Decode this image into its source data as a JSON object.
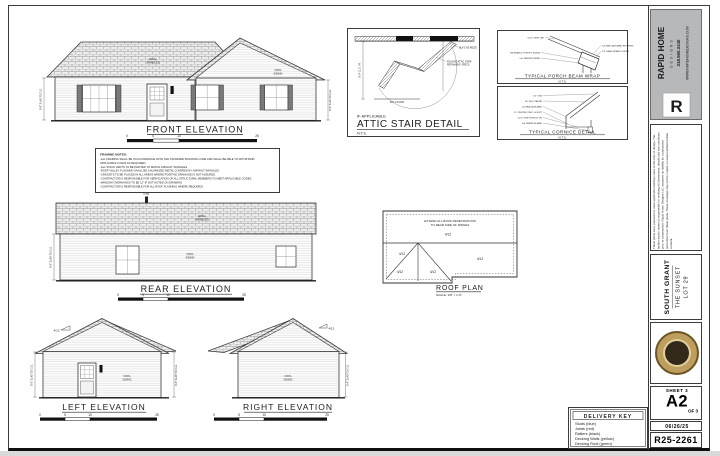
{
  "dims": {
    "wall_height": "8'-0\" SLAB TO CLG."
  },
  "scale_bar": {
    "ticks": [
      "0",
      "5",
      "10",
      "25"
    ]
  },
  "front_elevation": {
    "label": "FRONT ELEVATION",
    "roof_note_1": "ARCH.",
    "roof_note_2": "SHINGLES",
    "wall_note_1": "VINYL",
    "wall_note_2": "SIDING"
  },
  "rear_elevation": {
    "label": "REAR ELEVATION",
    "vent_note": "V.T.R.",
    "roof_note_1": "ARCH.",
    "roof_note_2": "SHINGLES",
    "wall_note_1": "VINYL",
    "wall_note_2": "SIDING"
  },
  "left_elevation": {
    "label": "LEFT ELEVATION",
    "slope": "4/12",
    "wall_note_1": "VINYL",
    "wall_note_2": "SIDING"
  },
  "right_elevation": {
    "label": "RIGHT ELEVATION",
    "slope": "4/12",
    "wall_note_1": "VINYL",
    "wall_note_2": "SIDING"
  },
  "roof_plan": {
    "label": "ROOF PLAN",
    "scale": "SCALE: 1/8\" = 1'-0\"",
    "note_1": "EXTEND ALL ROOF PENETRATIONS",
    "note_2": "TO REAR SIDE OF RIDGES",
    "slope": "4/12"
  },
  "attic_detail": {
    "pre_label": "IF APPLICABLE",
    "label": "ATTIC STAIR DETAIL",
    "scale": "N.T.S.",
    "dim": "8'-0\" CLG. HT.",
    "floor_note": "FIN. FLOOR",
    "callouts": [
      "BLK'G AS REQ'D",
      "FOLDING ATTIC STAIR",
      "PER MANUF. SPECS"
    ]
  },
  "porch_detail": {
    "label": "TYPICAL PORCH BEAM WRAP",
    "scale": "N.T.S.",
    "callouts": [
      "1-1/4\" DRIP CAP",
      "1x6 FASCIA BOARD RETURNS",
      "1/2\" BEAD BOARD SOFFIT",
      "ON BEAM (TYP BOTH SIDES)",
      "1x4 TRIM RETURNS"
    ]
  },
  "cornice_detail": {
    "label": "TYPICAL CORNICE DETAIL",
    "scale": "N.T.S.",
    "callouts": [
      "1/2\" OSB",
      "15# FELT PAPER",
      "1x6 FASCIA BOARD",
      "12\" VENTED VINYL SOFFIT",
      "1-1/2\" DRIP EDGE (TYP)",
      "1x4 FRIEZE BOARD"
    ]
  },
  "framing_notes": {
    "title": "FRAMING NOTES:",
    "lines": [
      "-ALL FRAMING SHALL BE IN ACCORDANCE WITH THE STANDARD BUILDING CODE AND SHALL BE ABLE TO WITHSTAND",
      " APPLICABLE LOADS AS REQUIRED.",
      "-ALL STACK VENTS TO BE PAINTED TO MATCH ASPHALT SHINGLES.",
      "-ROOF VALLEY FLASHING SHALL BE GALVANIZED METAL COVERED BY ASPHALT SHINGLES.",
      "-CRICKETS TO BE PLACED IN ALL AREAS WHERE POSITIVE DRAINAGE IS NOT ASSURED.",
      "-CONTRACTOR IS RESPONSIBLE FOR VERIFICATION OF ALL STRUCTURAL MEMBERS TO MEET APPLICABLE CODES.",
      "-WINDOW OVERHANGS TO BE 12\" IF NOT NOTED ON DRAWING.",
      "-CONTRACTOR IS RESPONSIBLE FOR ALL ROOF FLASHING WHERE REQUIRED."
    ]
  },
  "delivery_key": {
    "title": "DELIVERY KEY",
    "items": [
      "Studs  (blue)",
      "Joists  (red)",
      "Rafters  (black)",
      "Decking Walls  (yellow)",
      "Decking Roof  (green)"
    ]
  },
  "title_block": {
    "company": "RAPID HOME",
    "company_sub": "DESIGNS",
    "phone": "318.560.3440",
    "website": "WWW.RAPIDHOMEDESIGNS.COM",
    "logo_letter": "R",
    "accent": "#e2007a",
    "logo_bg": "#b7b8ba",
    "disclaimer": "These plans were prepared to meet applicable building codes at the time of design. The builder and/or owner is responsible for verifying all dimensions, details and site conditions prior to construction. Rapid Home Designs LLC assumes no liability for construction performed from these plans. These drawings may not be copied or reused without written consent.",
    "project_name": "SOUTH GRANT",
    "plan_name": "THE SUNSET",
    "lot": "LOT 29",
    "sheet_label": "SHEET 3",
    "sheet_number": "A2",
    "of_label": "OF 3",
    "date": "06/26/25",
    "plan_id": "R25-2261"
  }
}
